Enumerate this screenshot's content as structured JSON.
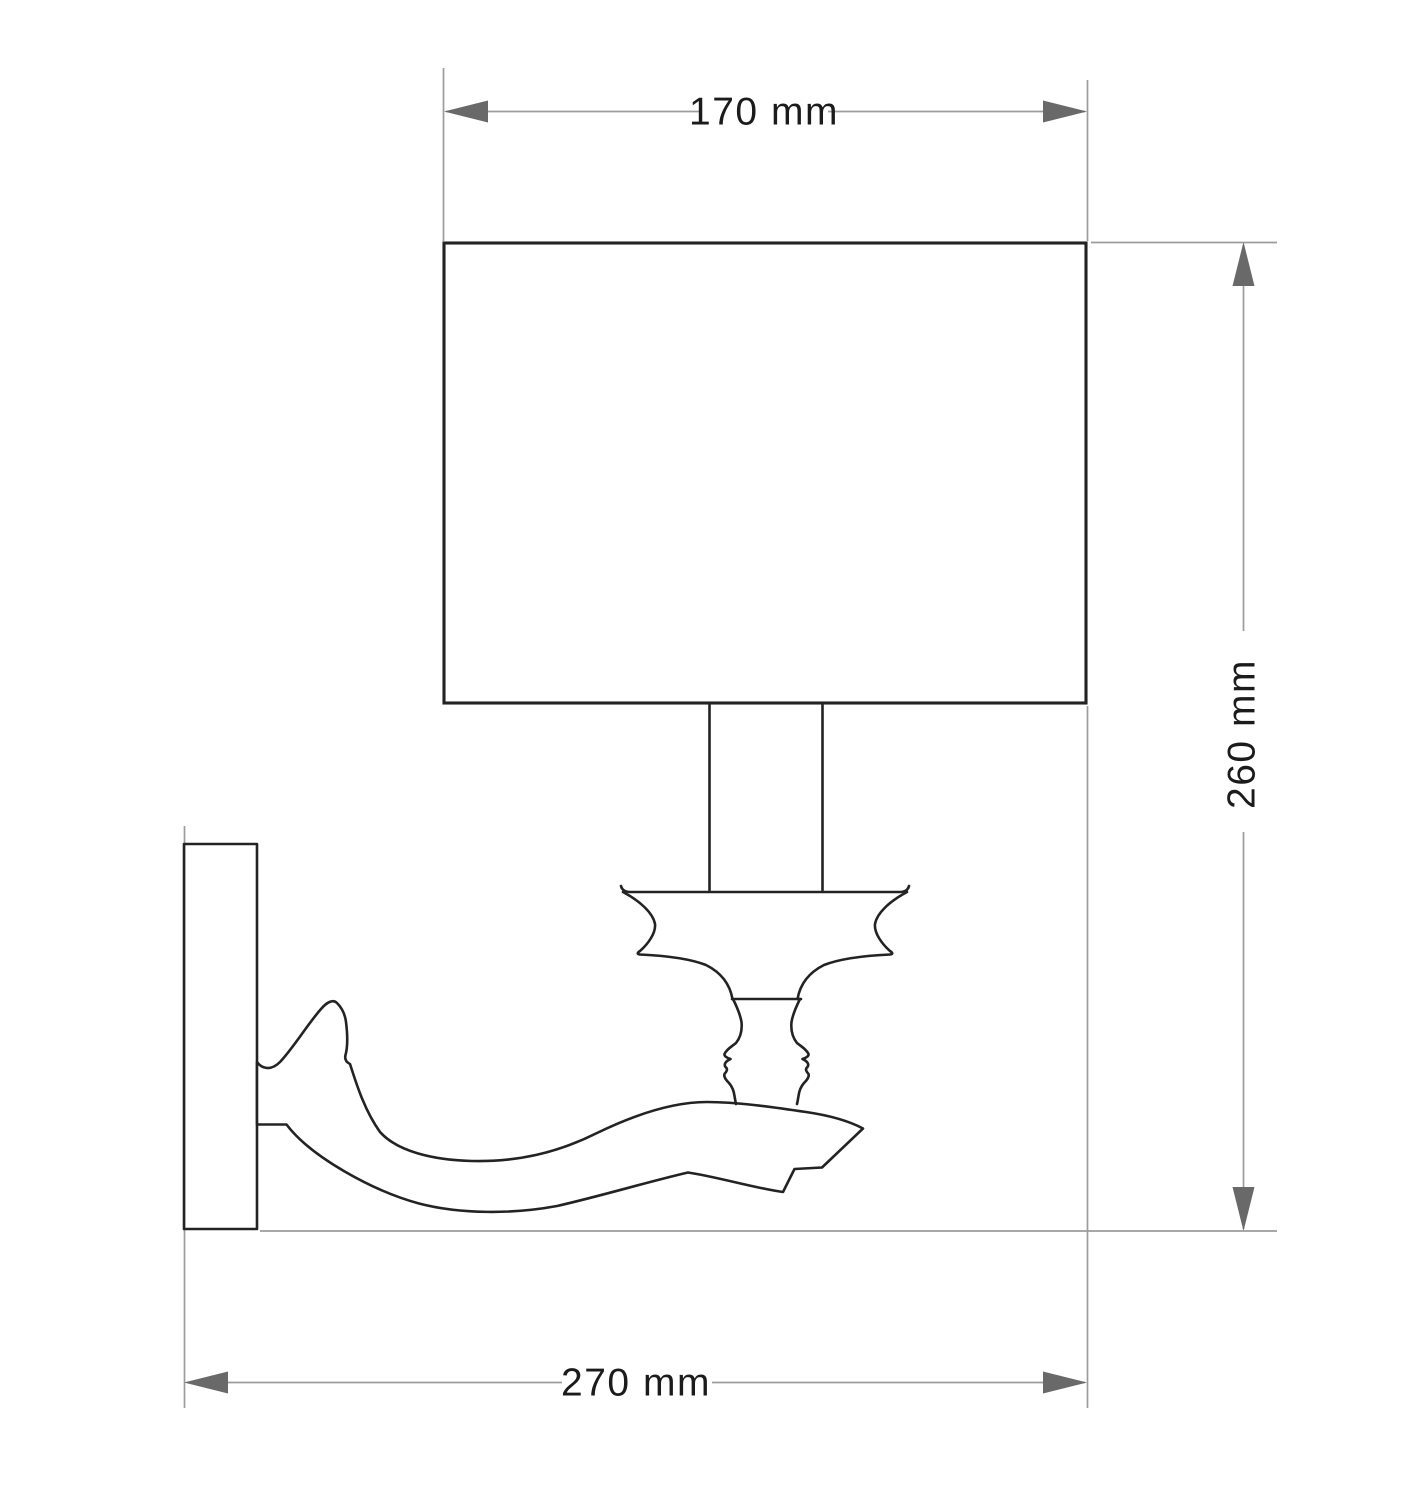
{
  "dimensions": {
    "top_width": {
      "label": "170 mm",
      "value": 170,
      "unit": "mm"
    },
    "right_height": {
      "label": "260 mm",
      "value": 260,
      "unit": "mm"
    },
    "bottom_depth": {
      "label": "270 mm",
      "value": 270,
      "unit": "mm"
    }
  },
  "colors": {
    "outline": "#232323",
    "dimension_line": "#9c9c9c",
    "arrowhead": "#696969",
    "label_text": "#1b1b1b",
    "background": "#ffffff"
  }
}
